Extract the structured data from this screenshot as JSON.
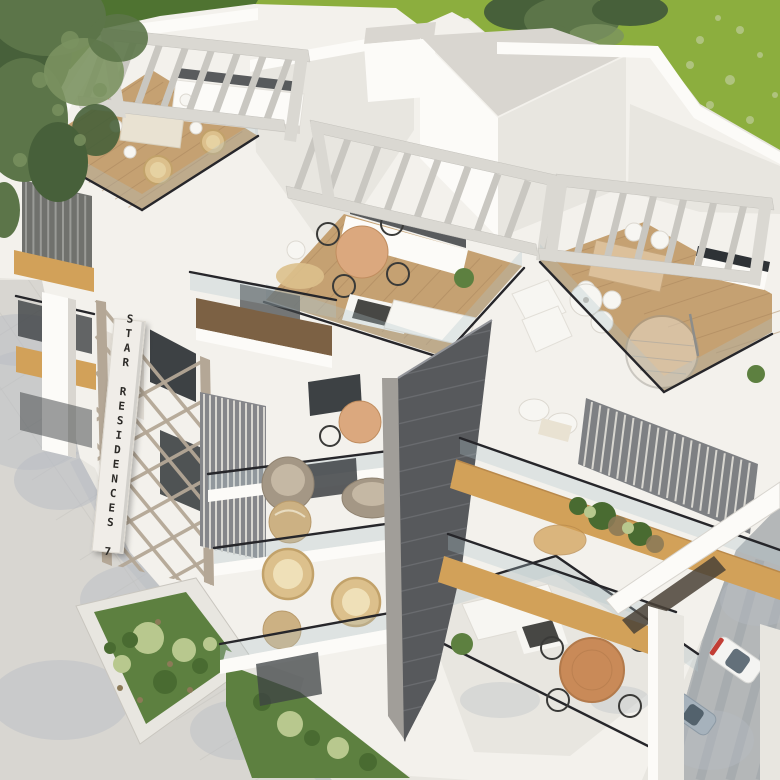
{
  "scene": {
    "kind": "3d-architectural-exterior-render",
    "subject": "Aerial corner view of a modern white residential building with rooftop terraces, pergolas, balconies, garden beds and street with parked cars",
    "sign": {
      "text": "STAR RESIDENCES 7"
    },
    "palette": {
      "lawn": "#8cae3e",
      "lawn_shade": "#4f7331",
      "foliage": "#5c7549",
      "foliage_dark": "#47603a",
      "foliage_light": "#7b9260",
      "wall": "#f3f1ec",
      "wall_bright": "#fcfbf8",
      "wall_mid": "#e8e6e0",
      "wall_shade": "#d9d6d0",
      "deck_wood": "#c5a172",
      "deck_dark": "#7c6144",
      "fascia_wood": "#d2a159",
      "tower_dark": "#57595c",
      "tower_light": "#a19e99",
      "tower_stripe": "#6d6f72",
      "pavement": "#d8d6d1",
      "pavement_shadow": "#b7bcc3",
      "road": "#b4b7b8",
      "road_shadow": "#989fa4",
      "planter_green": "#5d8040",
      "shrub_light": "#b8c88e",
      "shrub_dark": "#496b31",
      "marble": "#ccb183",
      "wicker": "#dcc08c",
      "armchair": "#a49785",
      "white_furniture": "#f7f6f2",
      "firepit": "#474744",
      "table_wood": "#c98a58",
      "counter_dark": "#2e3236",
      "window_dark": "#3d4144",
      "glass_tint": "#aec3cb",
      "rail_dark": "#26262a",
      "car_white": "#f4f4f2",
      "car_blue": "#a6b2bc",
      "car_red": "#c23e36",
      "car_glass": "#53626d",
      "pergola_beam": "#dad8d2",
      "pergola_slat": "#c9c7c1",
      "plank_line": "#a9855c",
      "paver_line": "#c9c7c2",
      "lattice": "#b4a796",
      "sign_bg": "#f0ede8",
      "sign_text": "#2c2a27"
    }
  }
}
